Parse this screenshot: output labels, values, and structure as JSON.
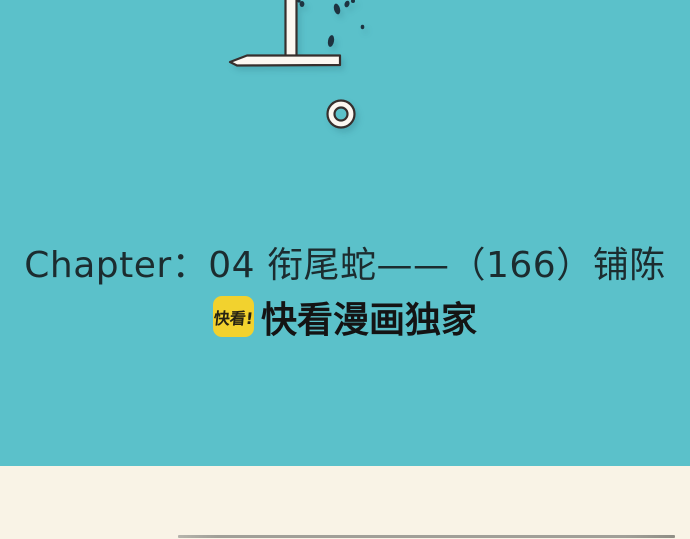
{
  "chapter": {
    "title": "Chapter：04 衔尾蛇——（166）铺陈"
  },
  "badge": {
    "logo_text": "快看!",
    "label": "快看漫画独家"
  },
  "colors": {
    "background_teal": "#5BC1CA",
    "panel_cream": "#F9F3E6",
    "title_text": "#1C2C2F",
    "badge_logo_bg": "#F2D22E",
    "badge_logo_text": "#262313",
    "badge_label_text": "#141414",
    "artwork_fill": "#FCF7F1",
    "artwork_outline": "#372F2D",
    "ink_splatter": "#1E3340",
    "divider_gray": "#A19F98"
  }
}
